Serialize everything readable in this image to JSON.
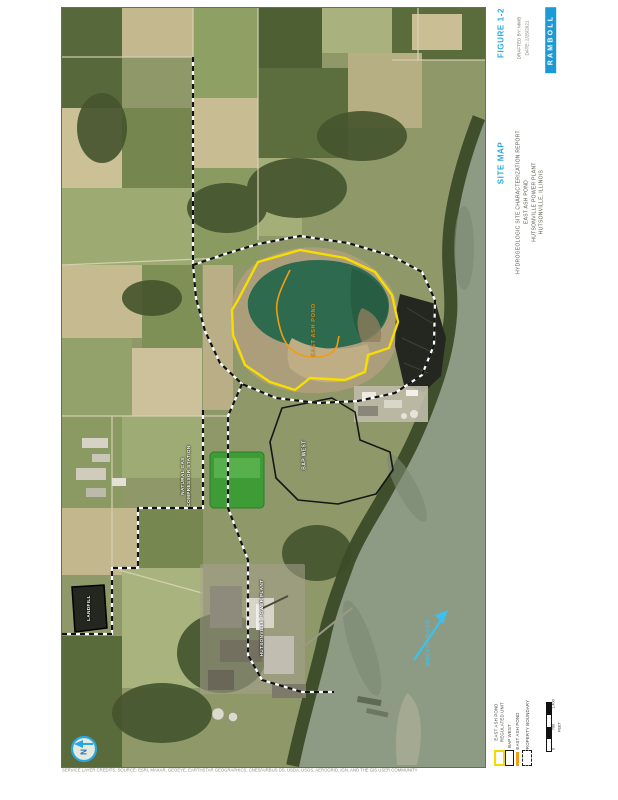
{
  "header": {
    "figure_label": "FIGURE 1-2",
    "meta_line1": "DRAFTED BY: MWB",
    "meta_line2": "DATE: 2/25/2021",
    "logo_text": "RAMBOLL",
    "map_title": "SITE MAP",
    "report_line1": "HYDROGEOLOGIC SITE CHARACTERIZATION REPORT",
    "report_line2": "EAST ASH POND",
    "report_line3": "HUTSONVILLE POWER PLANT",
    "report_line4": "HUTSONVILLE, ILLINOIS"
  },
  "map_labels": {
    "ash_pond": "EAST ASH POND",
    "bap_west": "BAP WEST",
    "compressor_line1": "NATURAL GAS",
    "compressor_line2": "COMPRESSOR STATION",
    "landfill": "LANDFILL",
    "power_plant": "HUTSONVILLE POWER PLANT",
    "river": "WABASH RIVER"
  },
  "north": {
    "label": "N"
  },
  "legend": {
    "items": [
      {
        "label": "EAST ASH POND",
        "label2": "REGULATED UNIT",
        "swatch": "yellow-outline"
      },
      {
        "label": "BAP WEST",
        "swatch": "black-outline"
      },
      {
        "label": "EAST ASH POND",
        "swatch": "orange-line"
      },
      {
        "label": "PROPERTY BOUNDARY",
        "swatch": "dashed-outline"
      }
    ]
  },
  "scale_bar": {
    "labels": [
      "1,400",
      "700",
      "0"
    ],
    "unit": "FEET"
  },
  "credits": "SERVICE LAYER CREDITS: SOURCE: ESRI, MAXAR, GEOEYE, EARTHSTAR GEOGRAPHICS, CNES/AIRBUS DS, USDA, USGS, AEROGRID, IGN, AND THE GIS USER COMMUNITY",
  "colors": {
    "accent_cyan": "#2FA9E1",
    "ramboll_blue": "#1C9AD6",
    "unit_yellow": "#F6DF00",
    "unit_orange": "#F39C12"
  }
}
